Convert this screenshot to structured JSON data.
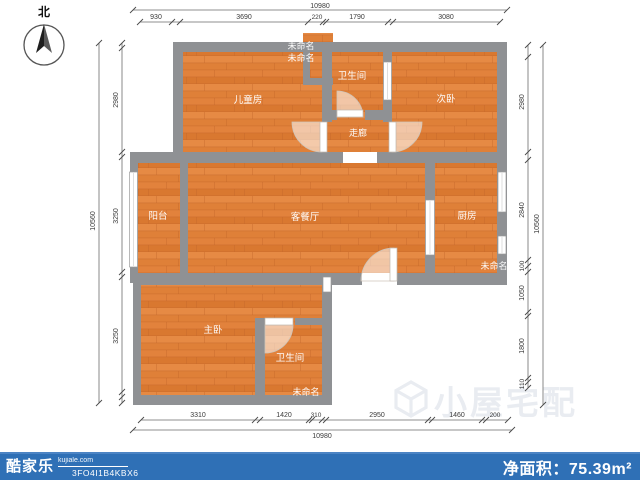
{
  "compass": {
    "label": "北"
  },
  "rooms": [
    {
      "id": "childrens-room",
      "label": "儿童房"
    },
    {
      "id": "bathroom-top",
      "label": "卫生间"
    },
    {
      "id": "secondary-bedroom",
      "label": "次卧"
    },
    {
      "id": "corridor",
      "label": "走廊"
    },
    {
      "id": "balcony",
      "label": "阳台"
    },
    {
      "id": "living-dining",
      "label": "客餐厅"
    },
    {
      "id": "kitchen",
      "label": "厨房"
    },
    {
      "id": "master-bedroom",
      "label": "主卧"
    },
    {
      "id": "bathroom-bottom",
      "label": "卫生间"
    },
    {
      "id": "unnamed-top-1",
      "label": "未命名"
    },
    {
      "id": "unnamed-top-2",
      "label": "未命名"
    },
    {
      "id": "unnamed-right",
      "label": "未命名"
    },
    {
      "id": "unnamed-bottom",
      "label": "未命名"
    }
  ],
  "dimensions": {
    "top": {
      "total": "10980",
      "segments": [
        "930",
        "3690",
        "220",
        "1790",
        "3080"
      ]
    },
    "bottom": {
      "total": "10980",
      "segments": [
        "3310",
        "1420",
        "310",
        "2950",
        "1460",
        "200"
      ]
    },
    "left": {
      "total": "10560",
      "segments": [
        "2980",
        "3250",
        "3250"
      ]
    },
    "right": {
      "total": "10560",
      "segments": [
        "2980",
        "2840",
        "100",
        "1050",
        "1800",
        "110"
      ]
    }
  },
  "watermark": {
    "text": "小屋宅配"
  },
  "footer": {
    "brand": "酷家乐",
    "domain": "kujiale.com",
    "plan_code": "3FO4I1B4KBX6",
    "area_label": "净面积：",
    "area_value": "75.39",
    "area_unit": "m²"
  },
  "colors": {
    "floor": "#E0823E",
    "wall": "#8F9194",
    "footer_bg": "#2F70B6",
    "footer_edge": "#4C84C4",
    "watermark": "#E9ECF1",
    "dimension_line": "#6B6B6B"
  }
}
